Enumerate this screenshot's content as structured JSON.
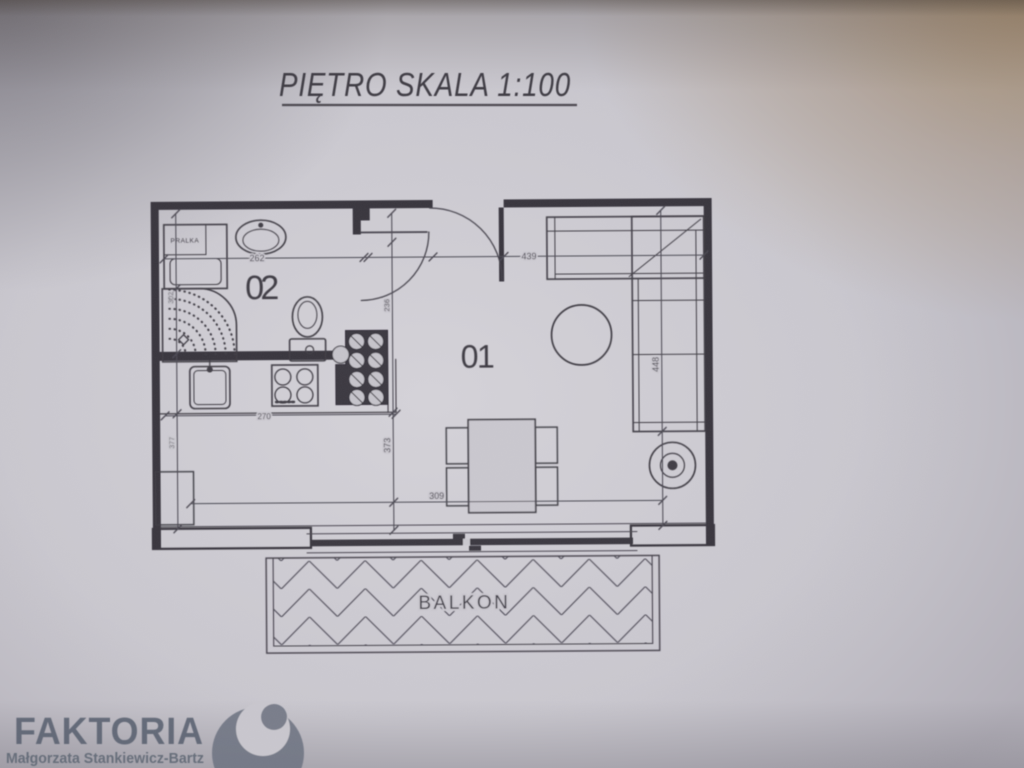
{
  "photo": {
    "paper_color": "#cac8cf",
    "line_color": "#45424b",
    "wall_color": "#39363e",
    "warm_corner_tint": "#a48864",
    "brand_color": "#535c6b",
    "logo_color": "#6d7381"
  },
  "title": {
    "text": "PIĘTRO SKALA 1:100"
  },
  "plan": {
    "rooms": [
      {
        "label": "01"
      },
      {
        "label": "02"
      }
    ],
    "fixtures": {
      "washer_label": "PRALKA"
    },
    "balcony": {
      "label": "BALKON"
    },
    "dims": {
      "bath_width": "262",
      "living_width": "439",
      "living_depth": "448",
      "counter_width": "270",
      "mid_depth": "373",
      "bottom_width": "309",
      "hall_depth": "236",
      "left_upper": "302",
      "left_lower": "377"
    }
  },
  "watermark": {
    "brand": "FAKTORIA",
    "subtitle": "Małgorzata Stankiewicz-Bartz"
  }
}
